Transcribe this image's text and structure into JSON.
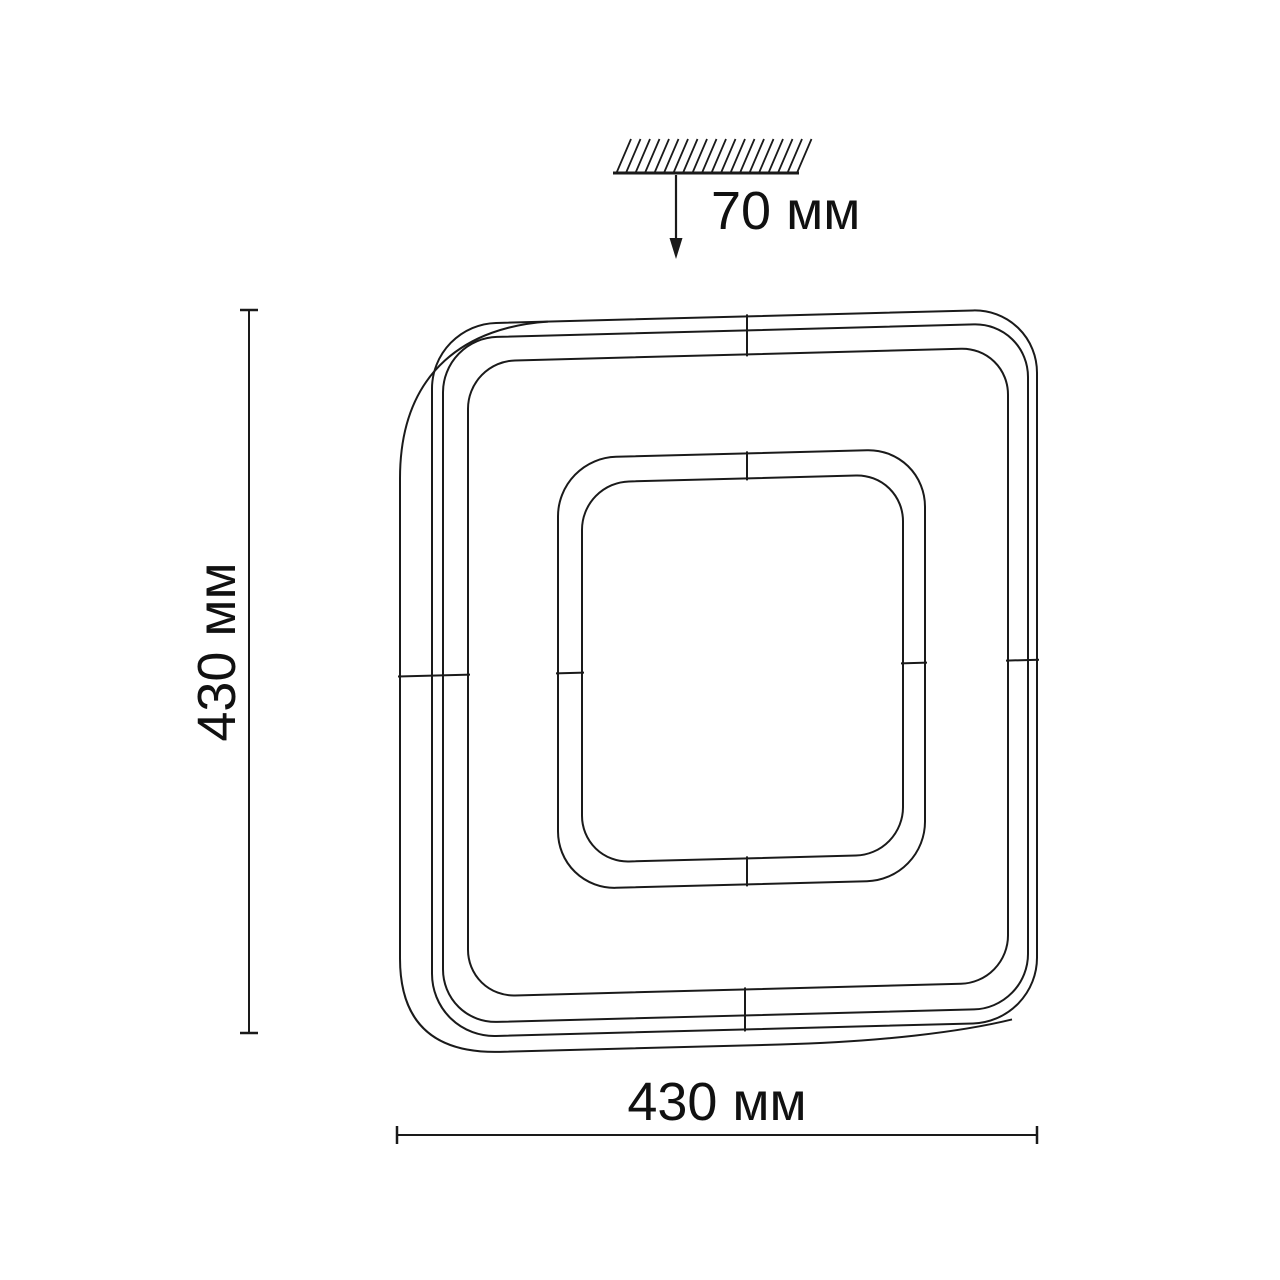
{
  "colors": {
    "background": "#ffffff",
    "line": "#1a1a1a",
    "text": "#111111"
  },
  "dimensions": {
    "depth_label": "70 мм",
    "height_label": "430 мм",
    "width_label": "430 мм"
  }
}
